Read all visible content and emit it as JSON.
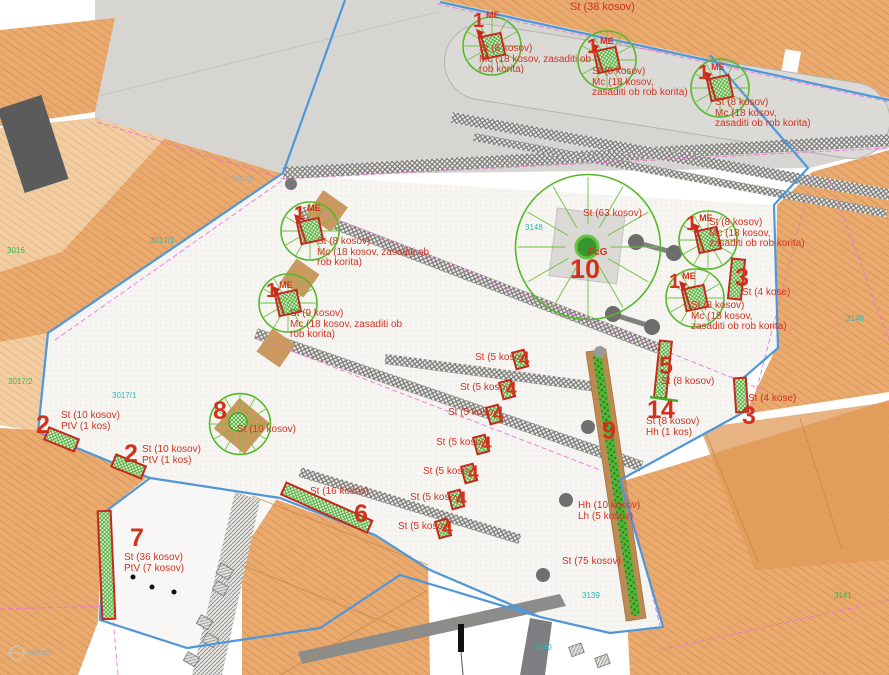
{
  "annotations": {
    "street": "St (38 kosov)",
    "trees": [
      {
        "num": "1",
        "code": "ME",
        "lines": [
          "St (8 kosov)",
          "Mc (18 kosov, zasaditi ob",
          "rob korita)"
        ]
      },
      {
        "num": "1",
        "code": "ME",
        "lines": [
          "St (8 kosov)",
          "Mc (18 kosov,",
          "zasaditi ob rob korita)"
        ]
      },
      {
        "num": "1",
        "code": "ME",
        "lines": [
          "St (8 kosov)",
          "Mc (18 kosov,",
          "zasaditi ob rob korita)"
        ]
      },
      {
        "num": "1",
        "code": "ME",
        "lines": [
          "St (8 kosov)",
          "Mc (18 kosov, zasaditi ob",
          "rob korita)"
        ]
      },
      {
        "num": "1",
        "code": "ME",
        "lines": [
          "St (9 kosov)",
          "Mc (18 kosov, zasaditi ob",
          "rob korita)"
        ]
      },
      {
        "num": "1",
        "code": "ME",
        "lines": [
          "St (8 kosov)",
          "Mc (18 kosov,",
          "zasaditi ob rob korita)"
        ]
      },
      {
        "num": "1",
        "code": "ME",
        "lines": [
          "St (8 kosov)",
          "Mc (18 kosov,",
          "zasaditi ob rob korita)"
        ]
      }
    ],
    "center_circle": {
      "num": "10",
      "species": "FcG",
      "count": "St (63 kosov)"
    },
    "circle8": {
      "num": "8",
      "count": "St (10 kosov)"
    },
    "planter2a": {
      "num": "2",
      "lines": [
        "St (10 kosov)",
        "PtV (1 kos)"
      ]
    },
    "planter2b": {
      "num": "2",
      "lines": [
        "St (10 kosov)",
        "PtV (1 kos)"
      ]
    },
    "planter3a": {
      "num": "3",
      "label": "St (4 kose)"
    },
    "planter3b": {
      "num": "3",
      "label": "St (4 kose)"
    },
    "planter5": {
      "num": "5",
      "label": "St (8 kosov)"
    },
    "planter6": {
      "num": "6",
      "label": "St (16 kosov)"
    },
    "planter7": {
      "num": "7",
      "lines": [
        "St (36 kosov)",
        "PtV (7 kosov)"
      ]
    },
    "planter9": {
      "num": "9"
    },
    "planter14": {
      "num": "14",
      "lines": [
        "St (8 kosov)",
        "Hh (1 kos)"
      ]
    },
    "row_planter": {
      "num": "4",
      "label": "St (5 kosov)"
    },
    "hedge": {
      "lines": [
        "Hh (10 kosov)",
        "Lh (5 kosov)"
      ]
    },
    "st75": "St (75 kosov)"
  },
  "parcels": {
    "a": "3016",
    "b": "3017/2",
    "c": "3017/1",
    "d": "3017/1",
    "e": "3148",
    "f": "3148",
    "g": "3139",
    "h": "3140",
    "i": "3141"
  },
  "elevations": {
    "a": "399.25",
    "b": "399.65"
  },
  "colors": {
    "annotation_red": "#cf3423",
    "tree_green": "#56b82a",
    "boundary_blue": "#4f97d8",
    "parcel_cyan": "#29b8b2",
    "parcel_green": "#3db54b",
    "roof_orange": "#ebaa6d",
    "strip_brown": "#bf8a52",
    "street_gray": "#d7d5d2",
    "magenta_dash": "#ef6fd7"
  }
}
